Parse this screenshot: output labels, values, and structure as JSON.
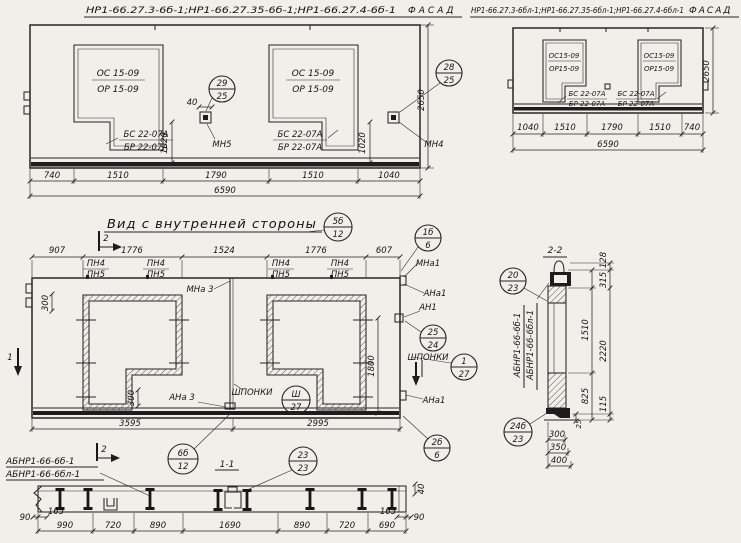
{
  "facade_left": {
    "title": "НР1-66.27.3-6б-1;НР1-66.27.35-6б-1;НР1-66.27.4-6б-1",
    "facade_word": "ФАСАД",
    "win1_top": "ОС 15-09",
    "win1_bot": "ОР 15-09",
    "win2_top": "ОС 15-09",
    "win2_bot": "ОР 15-09",
    "sill1_top": "БС 22-07А",
    "sill1_bot": "БР 22-07А",
    "sill2_top": "БС 22-07А",
    "sill2_bot": "БР 22-07А",
    "callout1_top": "29",
    "callout1_bot": "25",
    "callout2_top": "28",
    "callout2_bot": "25",
    "mn5": "МН5",
    "mn4": "МН4",
    "dim40": "40",
    "dim1020_l": "1020",
    "dim1020_r": "1020",
    "dim2650": "2650",
    "dims": [
      "740",
      "1510",
      "1790",
      "1510",
      "1040"
    ],
    "total": "6590"
  },
  "facade_right": {
    "title": "НР1-66.27.3-6бл-1;НР1-66.27.35-6бл-1;НР1-66.27.4-6бл-1",
    "facade_word": "ФАСАД",
    "win1_top": "ОС15-09",
    "win1_bot": "ОР15-09",
    "win2_top": "ОС15-09",
    "win2_bot": "ОР15-09",
    "sill1_top": "БС 22-07А",
    "sill1_bot": "БР 22-07А",
    "sill2_top": "БС 22-07А",
    "sill2_bot": "БР 22-07А",
    "dim2650": "2650",
    "dims": [
      "1040",
      "1510",
      "1790",
      "1510",
      "740"
    ],
    "total": "6590"
  },
  "inner": {
    "title": "Вид с внутренней стороны",
    "c_title_top": "5б",
    "c_title_bot": "12",
    "c_tr_top": "1б",
    "c_tr_bot": "6",
    "dims_top": [
      "907",
      "1776",
      "1524",
      "1776",
      "607"
    ],
    "pn4": "ПН4",
    "pn5": "ПН5",
    "mna3": "МНа 3",
    "ana3": "АНа 3",
    "mna1": "МНа1",
    "ana1": "АНа1",
    "an1": "АН1",
    "ana1b": "АНа1",
    "c25_top": "25",
    "c25_bot": "24",
    "shponki": "ШПОНКИ",
    "c_sh_r_top": "1",
    "c_sh_r_bot": "27",
    "shponki2": "ШПОНКИ",
    "c_sh_m_top": "Ш",
    "c_sh_m_bot": "27",
    "c_br_top": "2б",
    "c_br_bot": "6",
    "dim300a": "300",
    "dim300b": "300",
    "dim1800": "1800",
    "dims_bot": [
      "3595",
      "2995"
    ],
    "sec2": "2",
    "sec1": "1",
    "c6b_top": "6б",
    "c6b_bot": "12"
  },
  "parts": {
    "label1": "АБНР1-66-6б-1",
    "label2": "АБНР1-66-6бл-1"
  },
  "sec11": {
    "title": "1-1",
    "c_top": "23",
    "c_bot": "23",
    "dim40": "40",
    "dims": [
      "990",
      "720",
      "890",
      "1690",
      "890",
      "720",
      "690"
    ],
    "d90l": "90",
    "d165l": "165",
    "d165r": "165",
    "d90r": "90"
  },
  "sec22": {
    "title": "2-2",
    "c1_top": "20",
    "c1_bot": "23",
    "c2_top": "24б",
    "c2_bot": "23",
    "label1": "АБНР1-66-6б-1",
    "label2": "АБНР1-66-6бл-1",
    "d128": "128",
    "d315": "315",
    "d1510": "1510",
    "d2220": "2220",
    "d825": "825",
    "d115": "115",
    "d25": "25",
    "dims_bot": [
      "300",
      "350",
      "400"
    ]
  }
}
